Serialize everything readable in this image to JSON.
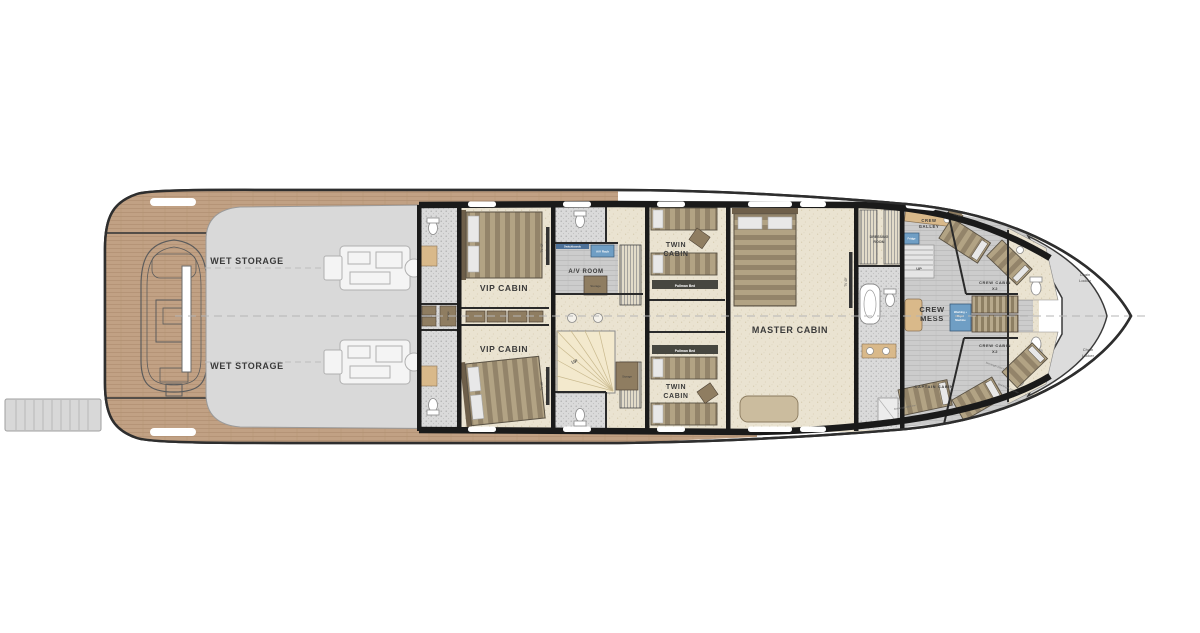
{
  "palette": {
    "background": "#ffffff",
    "hull_outline": "#2e2e2e",
    "wall_black": "#1a1a1a",
    "teak": "#c1a184",
    "deck_gray": "#d9d9d9",
    "floor_beige": "#eae3d1",
    "mosaic_gray": "#dadada",
    "crew_floor": "#cccccc",
    "stair_beige": "#f3e9cd",
    "furniture_brown": "#8f7d61",
    "bed_tan": "#b2a384",
    "accent_blue": "#6f9ec4",
    "bow_gray": "#dcdcdc"
  },
  "labels": {
    "wet_storage_top": "WET STORAGE",
    "wet_storage_bottom": "WET STORAGE",
    "vip_cabin_top": "VIP CABIN",
    "vip_cabin_bottom": "VIP CABIN",
    "av_room": "A/V ROOM",
    "av_rack": "A/V Rack",
    "switchboards": "Switchboards",
    "storage": "Storage",
    "up": "UP",
    "twin_line1": "TWIN",
    "twin_line2": "CABIN",
    "pullman_bed": "Pullman Bed",
    "master_cabin": "MASTER CABIN",
    "tv43": "TV 43\"",
    "tv49": "TV 49\"",
    "dressing_line1": "DRESSING",
    "dressing_line2": "ROOM",
    "crew_galley_line1": "CREW",
    "crew_galley_line2": "GALLEY",
    "fridge": "Fridge",
    "crew_mess_line1": "CREW",
    "crew_mess_line2": "MESS",
    "washer_line1": "Washing +",
    "washer_line2": "Dryer",
    "washer_line3": "Machine",
    "crew_cabin_line1": "CREW CABIN",
    "crew_cabin_line2": "X2",
    "captain_cabin": "CAPTAIN CABIN",
    "chain_line1": "Chain",
    "chain_line2": "Locker",
    "bed_length": "Bed length 2000 mm"
  }
}
